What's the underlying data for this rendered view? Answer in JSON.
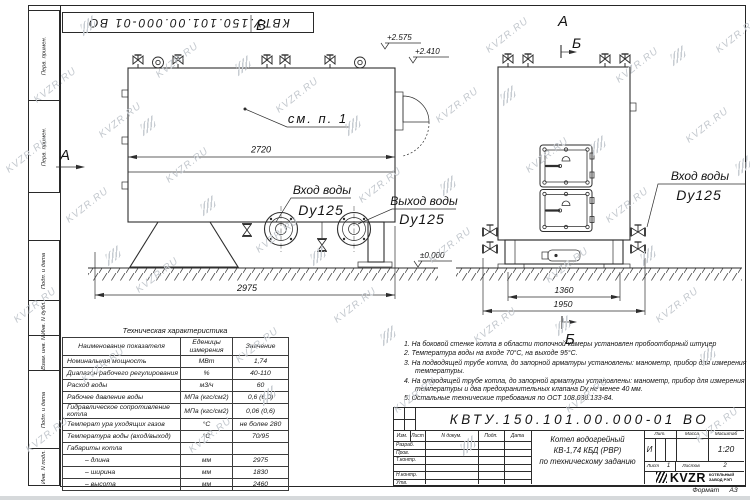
{
  "watermark": "KVZR.RU",
  "stamp": {
    "doc_number_inverted": "КВТУ.150.101.00.000-01 ВО"
  },
  "frame": {
    "col_labels": [
      "Перв. примен.",
      "Перв. примен.",
      "Подп. и дата",
      "Инв. N дубл.",
      "Взам. инв. N",
      "Подп. и дата",
      "Инв. N подл."
    ]
  },
  "drawing": {
    "view_b_label": "В",
    "view_a_left_label": "А",
    "view_a_right_label": "А",
    "section_b_top_label": "Б",
    "section_b_bottom_label": "Б",
    "see_note_callout": "см. п. 1",
    "elevation_top_valves": "+2.575",
    "elevation_boiler_top": "+2.410",
    "elevation_ground": "±0.000",
    "dim_inner_length": "2720",
    "dim_total_length": "2975",
    "dim_base_width": "1360",
    "dim_total_width": "1950",
    "inlet_front": {
      "line1": "Вход воды",
      "line2": "Dy125"
    },
    "outlet_front": {
      "line1": "Выход воды",
      "line2": "Dy125"
    },
    "inlet_side": {
      "line1": "Вход воды",
      "line2": "Dy125"
    }
  },
  "spec_table": {
    "title": "Техническая характеристика",
    "headers": [
      "Наименование показателя",
      "Еденицы измерения",
      "Значение"
    ],
    "rows": [
      [
        "Номинальная мощность",
        "МВт",
        "1,74"
      ],
      [
        "Диапазон рабочего регулирования",
        "%",
        "40-110"
      ],
      [
        "Расход воды",
        "м3/ч",
        "60"
      ],
      [
        "Рабочее давление воды",
        "МПа (кгс/см2)",
        "0,6 (6,0)"
      ],
      [
        "Гидравлическое сопротивление котла",
        "МПа (кгс/см2)",
        "0,06 (0,6)"
      ],
      [
        "Температ ура уходящих газов",
        "°С",
        "не более 280"
      ],
      [
        "Температура воды (вход/выход)",
        "°С",
        "70/95"
      ],
      [
        "Габариты котла",
        "",
        ""
      ],
      [
        "– длина",
        "мм",
        "2975"
      ],
      [
        "– ширина",
        "мм",
        "1830"
      ],
      [
        "– высота",
        "мм",
        "2460"
      ]
    ]
  },
  "notes": [
    "1.  На боковой стенке котла в области топочной камеры установлен пробоотборный штуцер",
    "2.  Температура воды на входе 70°С, на выходе 95°С.",
    "3.  На подводящей трубе котла, до запорной арматуры установлены: манометр, прибор для измерения температуры.",
    "4.  На отводящей трубе котла, до запорной арматуры установлены: манометр, прибор для измерения температуры и два предохранительных клапана Dу не менее 40 мм.",
    "5.  Остальные технические требования по ОСТ 108.030.133-84."
  ],
  "title_block": {
    "doc_number": "КВТУ.150.101.00.000-01 ВО",
    "columns": {
      "izm": "Изм.",
      "list": "Лист",
      "doc": "N докум.",
      "podp": "Подп.",
      "data": "Дата"
    },
    "roles": {
      "razrab": "Разраб.",
      "prov": "Пров.",
      "tkontr": "Т.контр.",
      "nkontr": "Н.контр.",
      "utv": "Утв."
    },
    "title_line1": "Котел водогрейный",
    "title_line2": "КВ-1,74 КБД (РВР)",
    "title_line3": "по техническому заданию",
    "lit_label": "Лит.",
    "lit_value": "И",
    "mass_label": "Масса",
    "scale_label": "Масштаб",
    "scale_value": "1:20",
    "sheet_label": "Лист",
    "sheet_value": "1",
    "sheets_label": "Листов",
    "sheets_value": "2",
    "logo_text": "KVZR",
    "company_line1": "КОТЕЛЬНЫЙ",
    "company_line2": "ЗАВОД РЭП",
    "format_label": "Формат",
    "format_value": "А3"
  }
}
